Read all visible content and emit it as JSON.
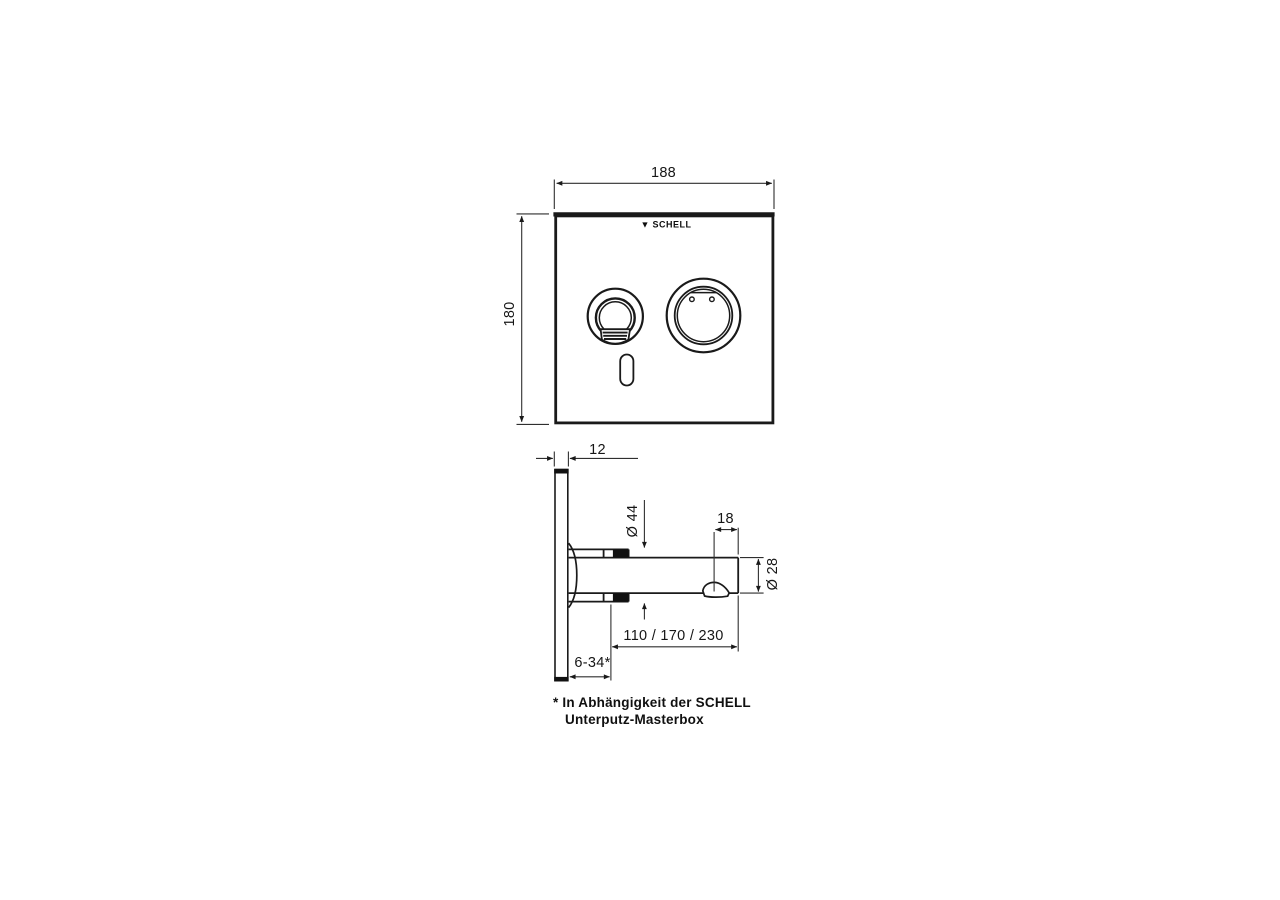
{
  "logo": {
    "glyph": "▼",
    "text": "SCHELL"
  },
  "front_view": {
    "width_mm": "188",
    "height_mm": "180"
  },
  "side_view": {
    "panel_thickness_mm": "12",
    "flange_diameter": "Ø 44",
    "outlet_length_mm": "18",
    "spout_diameter": "Ø 28",
    "spout_reach_mm": "110 / 170 / 230",
    "mounting_depth_mm": "6-34*"
  },
  "footnote": {
    "line1": "* In Abhängigkeit der SCHELL",
    "line2": "Unterputz-Masterbox"
  },
  "colors": {
    "line": "#1a1a1a",
    "background": "#ffffff"
  }
}
